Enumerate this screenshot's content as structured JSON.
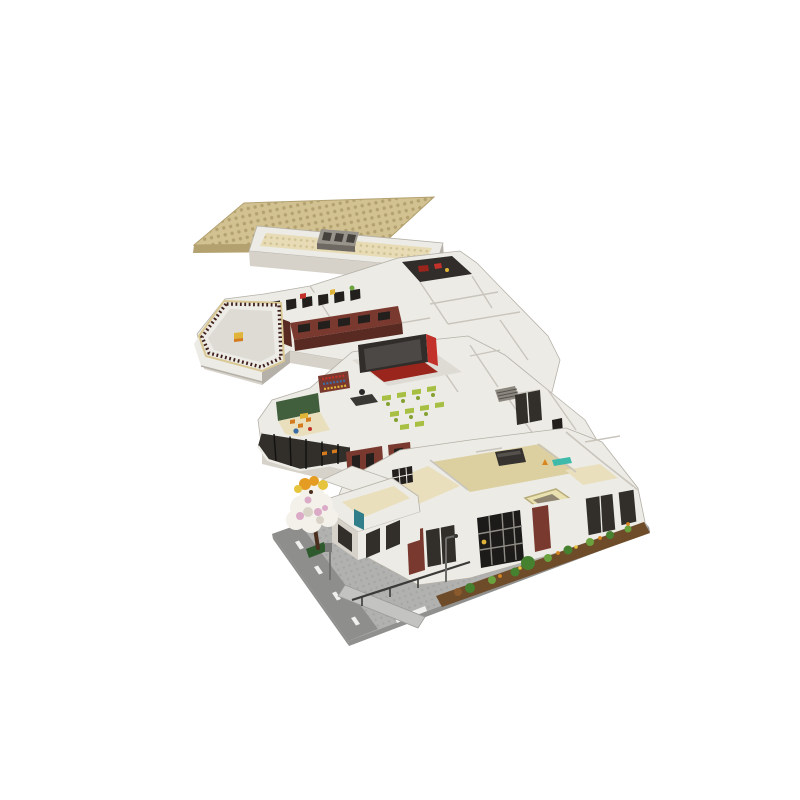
{
  "meta": {
    "type": "product-render",
    "alt": "Exploded isometric render of a four-level LEGO-style modular school building on a white background",
    "background": "#ffffff"
  },
  "scene": {
    "layers": [
      {
        "id": "roof-layer",
        "label": "studded roof plate with parapet tray and skylight vent"
      },
      {
        "id": "top-floor-layer",
        "label": "top floor with rooftop terrace, brick window walls and dark media room"
      },
      {
        "id": "middle-floor-layer",
        "label": "middle floor with classroom, display board, kids room and bay window"
      },
      {
        "id": "ground-floor-layer",
        "label": "ground floor on street baseplate with blossom tree, entrance and garden"
      }
    ]
  },
  "palette": {
    "bg": "#ffffff",
    "wallLight": "#ecebe5",
    "wallMid": "#d6d2ca",
    "wallShade": "#b5b1a8",
    "floorCream": "#e9dfbd",
    "floorTan": "#dccfa0",
    "floorGray": "#dedbd4",
    "roofTan": "#d3c291",
    "roofTanDark": "#b3a170",
    "creamStud": "#e7dcb5",
    "creamStudDark": "#cfc194",
    "ventGray": "#98948c",
    "ventShade": "#6e6a63",
    "ventDark": "#45423d",
    "brick": "#7a392f",
    "brickDark": "#582a22",
    "maroonRail": "#40201c",
    "railCoping": "#d9c893",
    "windowBlack": "#221f1d",
    "frameGray": "#8f8c85",
    "glassDark": "#322f2b",
    "boardDark": "#302d2a",
    "boardScreen": "#4b4845",
    "carpetRed": "#99251d",
    "redAccent": "#c2322a",
    "deskLime": "#a7c044",
    "deskLimeDark": "#85a132",
    "greenWall": "#415f3c",
    "orangeFurn": "#d47b1d",
    "yellowFurn": "#e0b438",
    "blueItem": "#3a6ca5",
    "tealDoor": "#2f7e89",
    "tealBench": "#3dbaaa",
    "plateGray": "#b1b1af",
    "plateEdge": "#90908e",
    "roadGray": "#8e8e8c",
    "dashWhite": "#f0f0ee",
    "gardenSoil": "#6e4b29",
    "gardenGreen": "#46812f",
    "gardenGreen2": "#6aa23d",
    "flowerOrange": "#d8861f",
    "treeTrunk": "#4a2f1f",
    "blossomWhite": "#f4f1eb",
    "blossomPink": "#daaac7",
    "blossomShade": "#d9d3c7",
    "blossomOrange": "#e59c23",
    "blossomYellow": "#e6c43d",
    "benchGreen": "#2e5a2e",
    "railDark": "#3a3a38",
    "rampGray": "#c3c3c1",
    "metalGray": "#6b6b69",
    "shaftCream": "#e9e1af",
    "shaftDark": "#8f8570",
    "wallStroke": "#c9c5bd"
  }
}
